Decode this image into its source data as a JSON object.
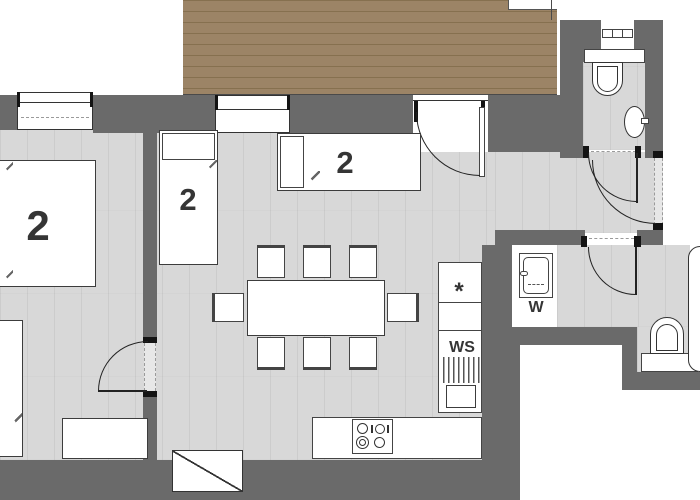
{
  "plan": {
    "type": "apartment-floor-plan",
    "beds": [
      {
        "id": "double-bed-left",
        "label": "2"
      },
      {
        "id": "single-bed-middle",
        "label": "2"
      },
      {
        "id": "single-bed-top",
        "label": "2"
      }
    ],
    "kitchen": {
      "fridge_symbol": "*",
      "sink_label": "WS"
    },
    "laundry": {
      "washer_label": "W"
    },
    "colors": {
      "wall": "#6a6a6a",
      "floor": "#d8d8d8",
      "deck_wood": "#9c8466",
      "fixture_border": "#3c3c3c",
      "label_text": "#353535"
    }
  }
}
